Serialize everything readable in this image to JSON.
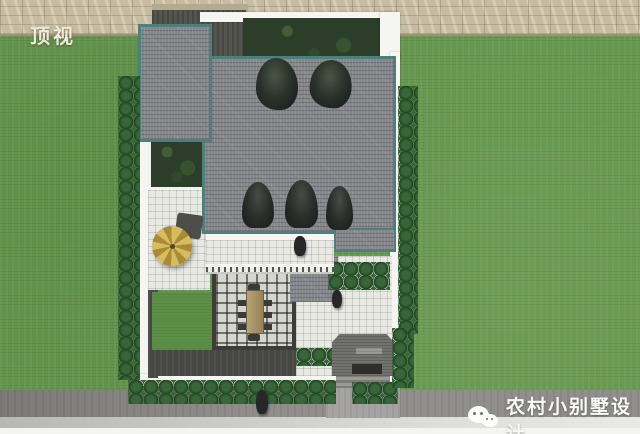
{
  "scene": {
    "view_label": "顶视",
    "watermark_text": "农村小别墅设计"
  },
  "icons": {
    "watermark_icon": "wechat-icon"
  },
  "palette": {
    "grass": "#66984f",
    "stone_wall": "#c7bca1",
    "roof_shingle": "#84868b",
    "roof_trim": "#4f7f7b",
    "courtyard_tile": "#e9e9e4",
    "boundary_wall": "#f5f5f1",
    "backyard_foliage": "#2c3e29",
    "umbrella": "#c9ad4e",
    "road": "#908f8d",
    "label_color": "#eee9d9",
    "watermark_text_color": "#fafaf7"
  }
}
